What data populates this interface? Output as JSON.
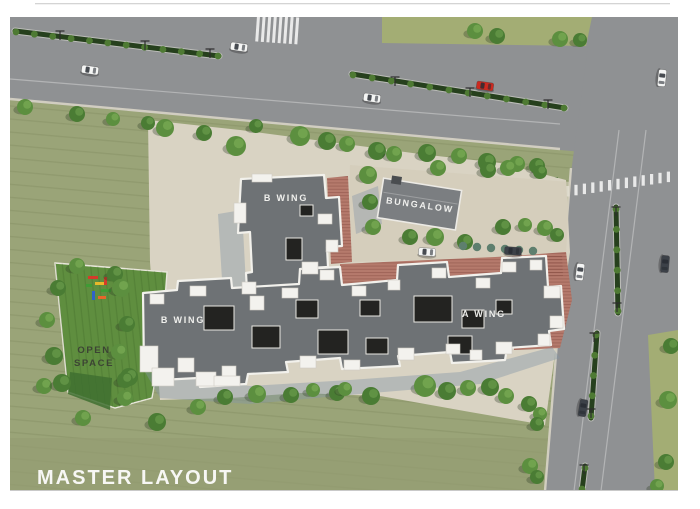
{
  "title": "MASTER LAYOUT",
  "labels": {
    "master_layout": "MASTER LAYOUT",
    "b_wing_top": "B WING",
    "b_wing_left": "B WING",
    "a_wing": "A WING",
    "bungalow": "BUNGALOW",
    "open_space_line1": "OPEN",
    "open_space_line2": "SPACE"
  },
  "colors": {
    "field": "#9aa478",
    "road": "#8f9193",
    "site_paving": "#d9d3c3",
    "lawn": "#5f8e3f",
    "brick_path": "#b57a6c",
    "roof": "#6e7275",
    "bungalow_roof": "#7b7e81",
    "building_shadow": "#8496a8",
    "label_text": "#f7f7f4",
    "open_space_text": "#3c4434",
    "car_red": "#cc2a20",
    "top_grass": "#a3ad74"
  }
}
